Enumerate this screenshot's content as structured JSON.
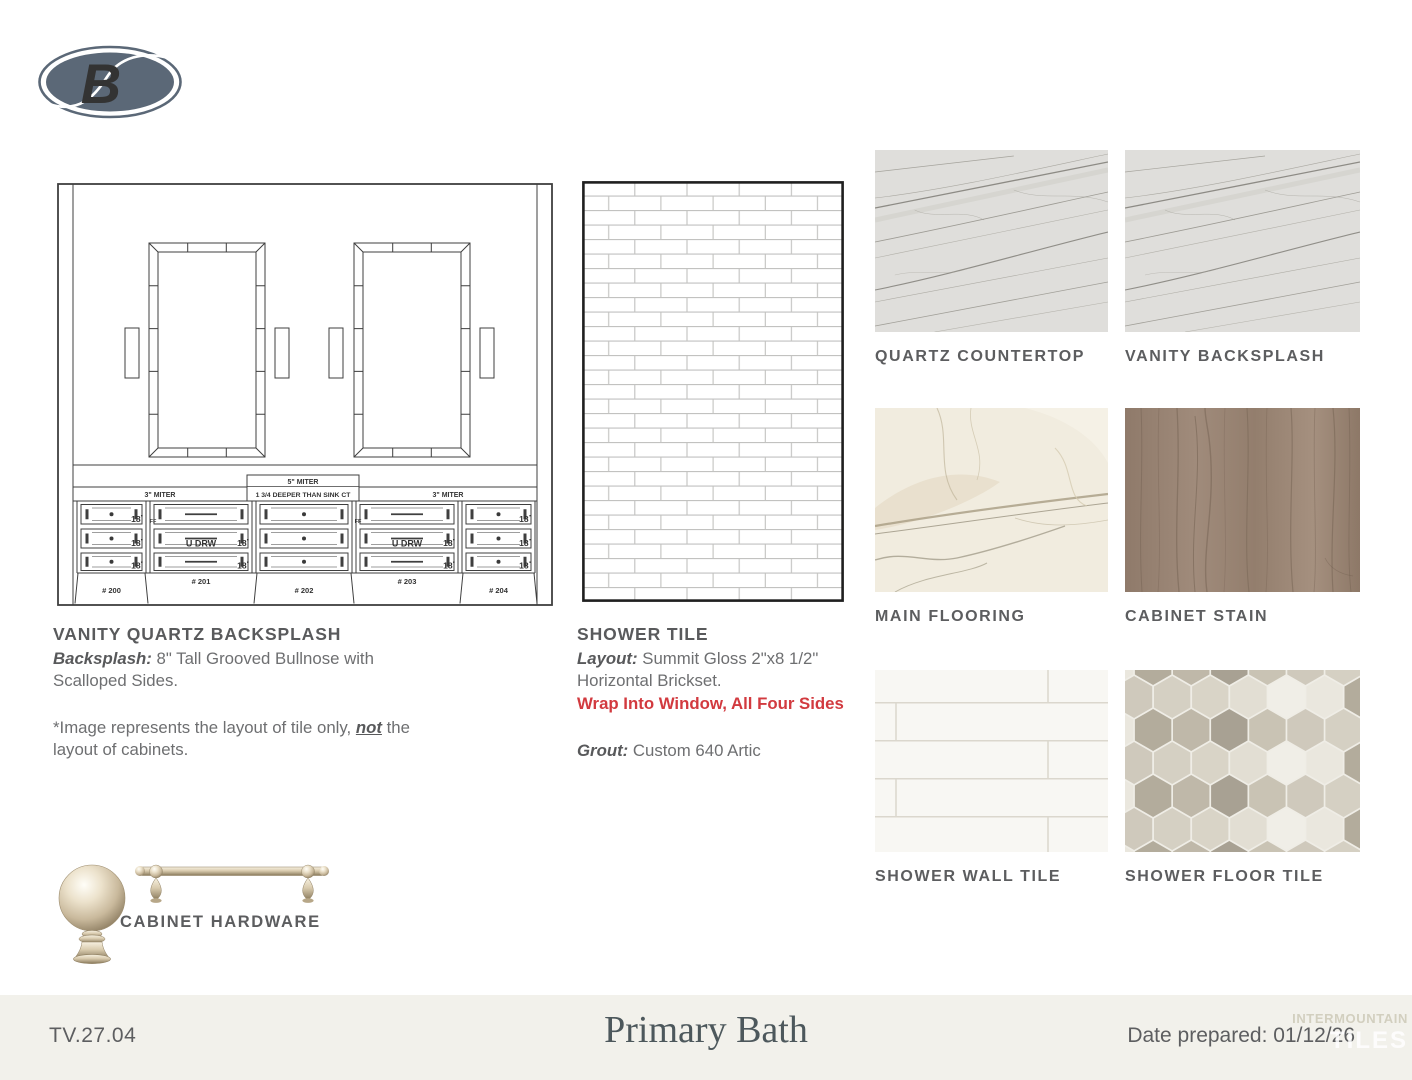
{
  "logo": {
    "letter": "B"
  },
  "vanity_section": {
    "heading": "VANITY QUARTZ BACKSPLASH",
    "spec_label": "Backsplash:",
    "spec_text": " 8\" Tall Grooved Bullnose with Scalloped Sides.",
    "note_prefix": "*Image represents the layout of tile only, ",
    "note_emphasis": "not",
    "note_suffix": " the layout of cabinets."
  },
  "vanity_drawing": {
    "miter_left": "3\" MITER",
    "miter_center_top": "5\" MITER",
    "miter_center_bottom": "1 3/4 DEEPER THAN SINK CT",
    "miter_right": "3\" MITER",
    "drawer_width": "18",
    "inch_mark": "\"",
    "u_drawer": "U DRW",
    "filler": "FF",
    "cabinet_numbers": [
      "# 200",
      "# 201",
      "# 202",
      "# 203",
      "# 204"
    ]
  },
  "shower_section": {
    "heading": "SHOWER TILE",
    "layout_label": "Layout:",
    "layout_text": " Summit Gloss 2\"x8 1/2\" Horizontal Brickset.",
    "warning": "Wrap Into Window, All Four Sides",
    "grout_label": "Grout:",
    "grout_text": " Custom 640 Artic"
  },
  "swatches": [
    {
      "label": "QUARTZ COUNTERTOP"
    },
    {
      "label": "VANITY BACKSPLASH"
    },
    {
      "label": "MAIN FLOORING"
    },
    {
      "label": "CABINET STAIN"
    },
    {
      "label": "SHOWER WALL TILE"
    },
    {
      "label": "SHOWER FLOOR TILE"
    }
  ],
  "hardware": {
    "label": "CABINET HARDWARE"
  },
  "footer": {
    "code": "TV.27.04",
    "title": "Primary Bath",
    "date": "Date prepared: 01/12/26",
    "watermark_top": "INTERMOUNTAIN",
    "watermark_bottom": "TILES"
  },
  "colors": {
    "accent_red": "#d23a3f",
    "logo_slate": "#5b6877",
    "text_gray": "#58595b",
    "footer_bg": "#f2f1eb"
  }
}
